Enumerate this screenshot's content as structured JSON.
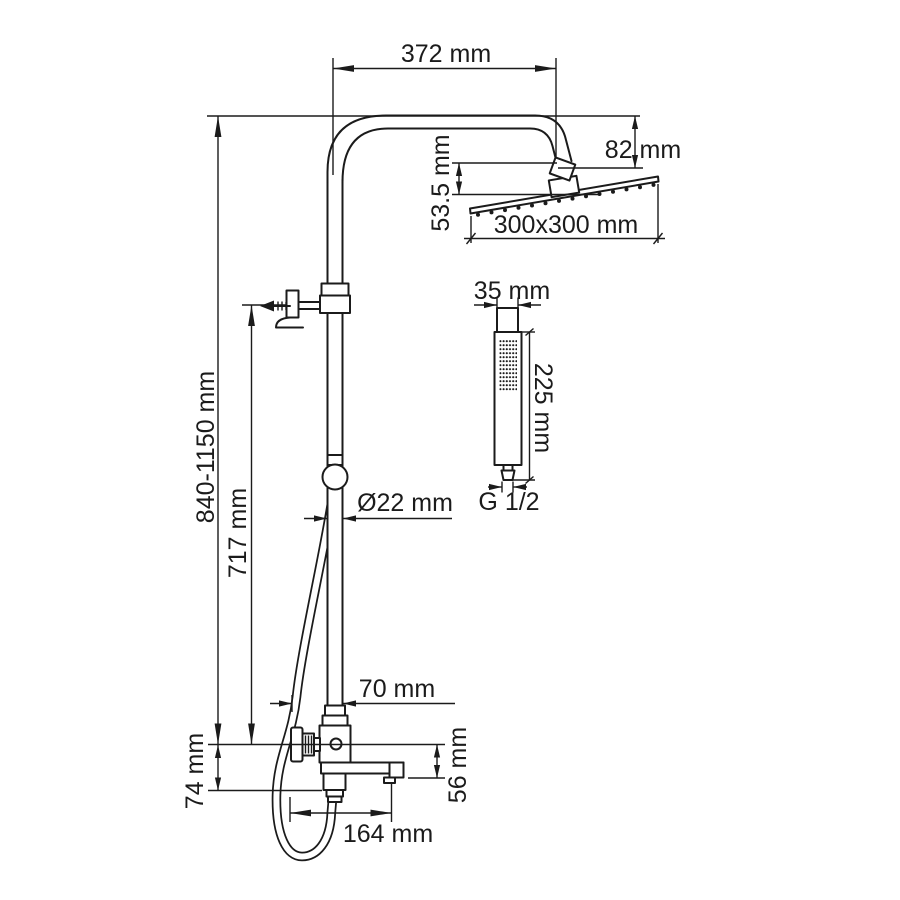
{
  "diagram": {
    "type": "technical-drawing",
    "subject": "shower column with overhead shower head, hand shower and swivel spout mixer",
    "unit": "mm",
    "labels": {
      "arm_reach": "372 mm",
      "head_drop": "82 mm",
      "head_connection": "53.5 mm",
      "head_size": "300x300 mm",
      "handshower_width": "35 mm",
      "handshower_length": "225 mm",
      "hose_thread": "G 1/2",
      "pipe_diameter": "Ø22 mm",
      "column_height": "840-1150 mm",
      "bracket_height": "717 mm",
      "mixer_center_height": "74 mm",
      "spout_drop": "56 mm",
      "spout_reach": "164 mm",
      "pipe_offset": "70 mm"
    }
  }
}
